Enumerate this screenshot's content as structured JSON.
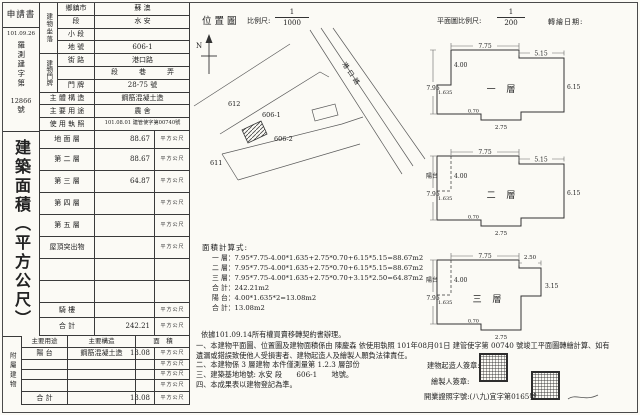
{
  "receipt": {
    "applicant": "申請書",
    "date": "101.09.26",
    "no_prefix": "羅測建字第",
    "no": "12866",
    "no_suffix": "號"
  },
  "site": {
    "group1_label": "建物坐落",
    "group2_label": "建物門牌",
    "rows": [
      {
        "label": "鄉鎮市",
        "value": "蘇 澳",
        "suffix": ""
      },
      {
        "label": "段",
        "value": "水 安",
        "suffix": "段"
      },
      {
        "label": "小 段",
        "value": "",
        "suffix": "小段"
      },
      {
        "label": "地 號",
        "value": "606-1",
        "suffix": "地號"
      },
      {
        "label": "街 路",
        "value": "港口路",
        "suffix": "街路"
      },
      {
        "label": "",
        "value": "段　　　巷　　　弄",
        "suffix": ""
      },
      {
        "label": "門 牌",
        "value": "28-75 號",
        "suffix": "樓"
      }
    ],
    "full_rows": [
      {
        "label": "主 體 構 造",
        "value": "鋼筋混凝土造"
      },
      {
        "label": "主 要 用 途",
        "value": "農 舍"
      },
      {
        "label": "使 用 執 照",
        "value": "101.08.01 建管使字第00740號"
      }
    ]
  },
  "area_title": "建築面積（平方公尺）",
  "floors": {
    "rows": [
      {
        "label": "地 面 層",
        "value": "88.67",
        "unit": "平方公尺"
      },
      {
        "label": "第 二 層",
        "value": "88.67",
        "unit": "平方公尺"
      },
      {
        "label": "第 三 層",
        "value": "64.87",
        "unit": "平方公尺"
      },
      {
        "label": "第 四 層",
        "value": "",
        "unit": "平方公尺"
      },
      {
        "label": "第 五 層",
        "value": "",
        "unit": "平方公尺"
      },
      {
        "label": "屋頂突出物",
        "value": "",
        "unit": "平方公尺"
      },
      {
        "label": "",
        "value": "",
        "unit": ""
      },
      {
        "label": "",
        "value": "",
        "unit": ""
      },
      {
        "label": "騎 樓",
        "value": "",
        "unit": "平方公尺"
      },
      {
        "label": "合 計",
        "value": "242.21",
        "unit": "平方公尺"
      }
    ]
  },
  "annex": {
    "side_label": "附屬建物",
    "headers": [
      "主要用途",
      "主要構造",
      "面　積"
    ],
    "rows": [
      {
        "use": "陽 台",
        "structure": "鋼筋混凝土造",
        "value": "13.08",
        "unit": "平方公尺"
      },
      {
        "use": "",
        "structure": "",
        "value": "",
        "unit": "平方公尺"
      },
      {
        "use": "",
        "structure": "",
        "value": "",
        "unit": "平方公尺"
      },
      {
        "use": "",
        "structure": "",
        "value": "",
        "unit": "平方公尺"
      },
      {
        "use": "合 計",
        "structure": "",
        "value": "13.08",
        "unit": "平方公尺"
      }
    ]
  },
  "map": {
    "title": "位置圖",
    "scale_label": "比例尺:",
    "scale_num": "1",
    "scale_den": "1000",
    "north": "N",
    "parcels": {
      "p612": "612",
      "p606_1": "606-1",
      "p606_2": "606-2",
      "p611": "611"
    },
    "road": "港口路"
  },
  "plans_header": {
    "scale_label": "平面圖比例尺:",
    "scale_num": "1",
    "scale_den": "200",
    "redraw_label": "轉繪日期:"
  },
  "plans": [
    {
      "name": "一 層",
      "balcony": "",
      "dims": {
        "top": "7.75",
        "ext_top": "5.15",
        "ext_side": "6.15",
        "left": "7.95",
        "inner": "4.00",
        "notch": "1.635",
        "step": "0.70",
        "tab": "2.75"
      }
    },
    {
      "name": "二 層",
      "balcony": "陽台",
      "dims": {
        "top": "7.75",
        "ext_top": "5.15",
        "ext_side": "6.15",
        "left": "7.95",
        "inner": "4.00",
        "notch": "1.635",
        "step": "0.70",
        "tab": "2.75"
      }
    },
    {
      "name": "三 層",
      "balcony": "陽台",
      "dims": {
        "top": "7.75",
        "ext_top": "2.50",
        "ext_side": "3.15",
        "left": "7.95",
        "inner": "4.00",
        "notch": "1.635",
        "step": "0.70",
        "tab": "2.75"
      }
    }
  ],
  "calc": {
    "title": "面積計算式:",
    "lines": [
      "一 層：7.95*7.75-4.00*1.635+2.75*0.70+6.15*5.15=88.67m2",
      "二 層：7.95*7.75-4.00*1.635+2.75*0.70+6.15*5.15=88.67m2",
      "三 層：7.95*7.75-4.00*1.635+2.75*0.70+3.15*2.50=64.87m2",
      "合 計：242.21m2",
      "陽 台：4.00*1.635*2=13.08m2",
      "合 計：13.08m2"
    ]
  },
  "notes": {
    "basis": "依據101.09.14所有權買賣移轉契約書辦理。",
    "items": [
      "一、本建物平面圖、位置圖及建物面積係由 陳慶森 依使用執照 101年08月01日 建管使字第 00740 號竣工平面圖轉繪計算、如有遺漏或錯誤致使他人受損害者、建物起造人及繪製人願負法律責任。",
      "二、本建物係 3 層建物 本件僅測量第 1.2.3 層部份",
      "三、建築基地地號: 水安 段　　606-1　　地號。",
      "四、本成果表以建物登記為準。"
    ]
  },
  "signoff": {
    "builder_label": "建物起造人簽章:",
    "drafter_label": "繪製人簽章:",
    "license_label": "開業證照字號:(八九)宜字第0165號"
  }
}
